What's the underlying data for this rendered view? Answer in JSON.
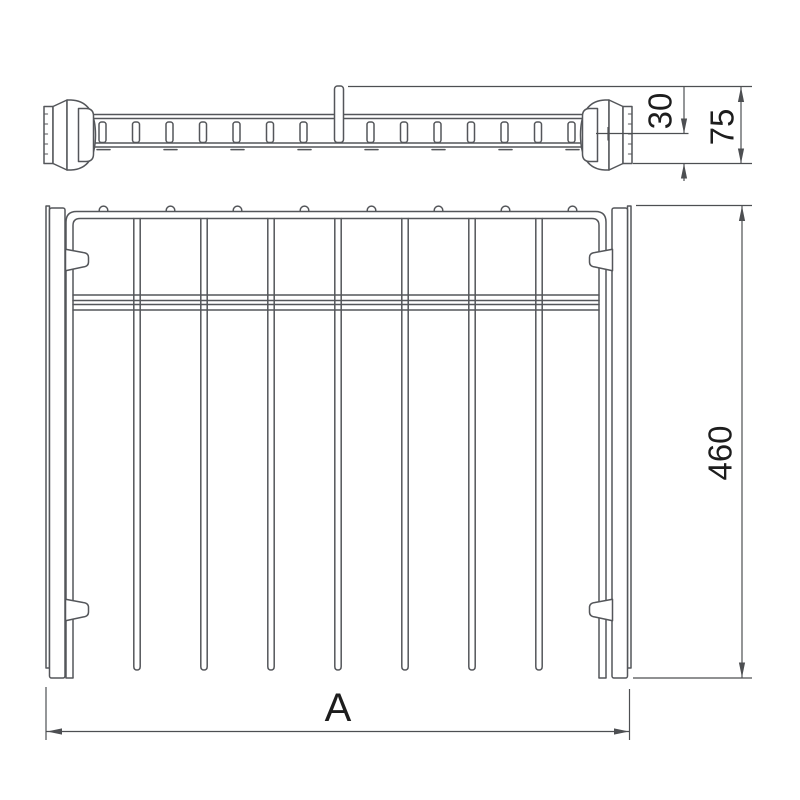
{
  "drawing": {
    "kind": "orthographic technical line drawing",
    "subject": "pull-out wardrobe hanger rail rack: side elevation of rail with end caps (top), plan view of frame with hanging rods (bottom)",
    "background": "#ffffff",
    "line_color": "#54565a",
    "dimension_line_color": "#4d4f52",
    "label_color": "#1d1d1d"
  },
  "labels": {
    "dim_30": "30",
    "dim_75": "75",
    "dim_460": "460",
    "dim_A": "A"
  },
  "counts": {
    "hanging_rods": 7,
    "hook_loops": 8,
    "rail_slats": 14,
    "hook_tabs_below_rail": 8,
    "mounting_tabs": 4,
    "cross_bars": 2
  }
}
